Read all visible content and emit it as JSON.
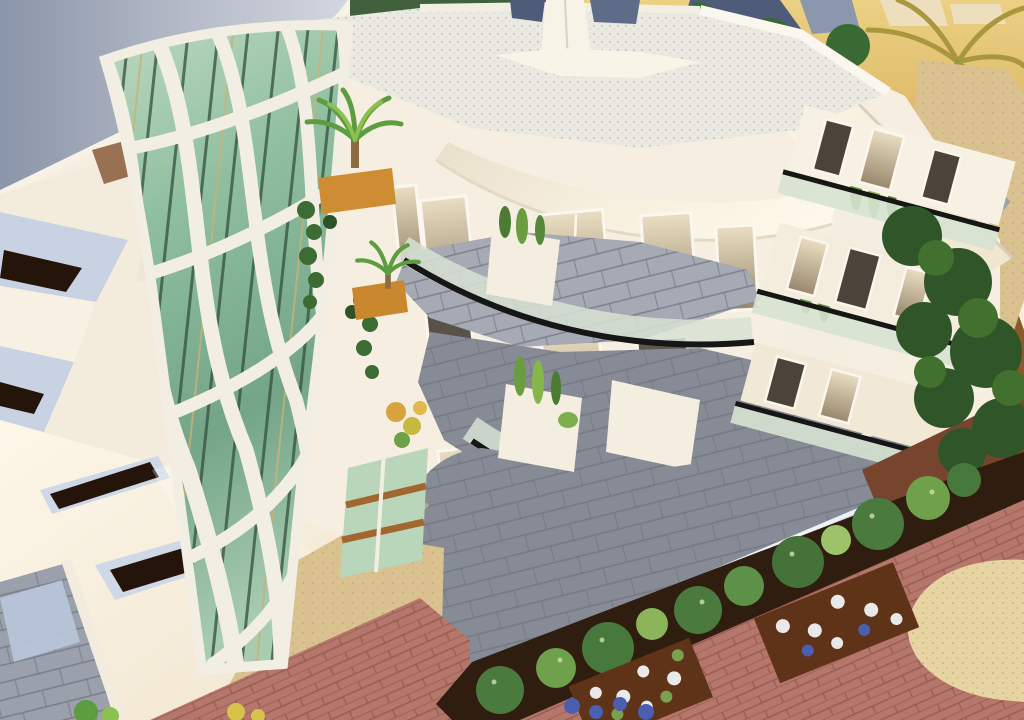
{
  "meta": {
    "type": "architectural-3d-rendering",
    "view": "aerial-oblique",
    "subject": "modern white apartment building with organic lattice facade tower, curved glass balconies, roof terrace, gardens and brick pathways at sunset"
  },
  "scene": {
    "elements": [
      "curved-canopy-roof",
      "lattice-tower",
      "green-glass-curtain-wall",
      "roof-terrace",
      "rooftop-column",
      "curved-white-fascia",
      "facade-windows",
      "glass-balustrades",
      "tiled-terraces",
      "white-planters",
      "cypress-shrubs",
      "balcony-palm-trees",
      "cascading-vines",
      "garden-bushes",
      "flower-beds",
      "brick-paving",
      "sand-pathway",
      "background-palms",
      "background-trees"
    ]
  },
  "palette": {
    "canopy_dark": "#8b95a9",
    "canopy_light": "#d3d7e0",
    "wall_white": "#f6efe1",
    "wall_warm": "#fdf6e6",
    "wall_shadow": "#e6dbc7",
    "roof_deck": "#ece9e0",
    "roof_dot": "#a9b6c9",
    "column_cap": "#4e5c7a",
    "column_cap2": "#5e6c88",
    "gold_bg": "#e2b763",
    "gold_bg_dark": "#c89a45",
    "backdrop_tree": "#3a6a33",
    "backdrop_roof_blue": "#4e5c7a",
    "glass_warm_hi": "#eadec2",
    "glass_warm_lo": "#99876c",
    "window_dark": "#4a443a",
    "frame_white": "#fbf7ee",
    "tile_gray": "#878b96",
    "tile_light": "#a6aab4",
    "tile_joint": "#6e727c",
    "balustrade_glass": "#d6e2d2",
    "rail_black": "#161616",
    "rail_steel": "#9fb0c0",
    "planter_white": "#f4eee1",
    "cypress_green": "#6b9c3f",
    "cypress_dark": "#4c7c33",
    "vine_green": "#3c6b33",
    "palm_green": "#5d9c3f",
    "palm_light": "#8cc050",
    "planter_wood": "#cf8d33",
    "mint_glass": "#b9d6bb",
    "wood_strip": "#a2672f",
    "soil_brown": "#2f1d10",
    "bush_green": "#4a7a3e",
    "bush_mid": "#6fa04a",
    "bush_light": "#8ab55a",
    "brick_pink": "#b5766b",
    "brick_mortar": "#96594f",
    "sand_tan": "#d9c190",
    "sand_cream": "#e7d4a3",
    "ground_rust": "#77452e",
    "tree_dark": "#2f5529",
    "tree_mid": "#41702f",
    "flowerbed_brown": "#5f3317",
    "flower_white": "#e9e9e9",
    "flower_blue": "#4a5fb0",
    "path_brown": "#8a5a2a",
    "slab_blue": "#c9d2e2",
    "slit_dark": "#241409",
    "lattice_white": "#f2eee3",
    "mullion_dark": "#33503f",
    "peach_wall": "#edc4a4",
    "corner_tile": "#9aa0ac"
  }
}
